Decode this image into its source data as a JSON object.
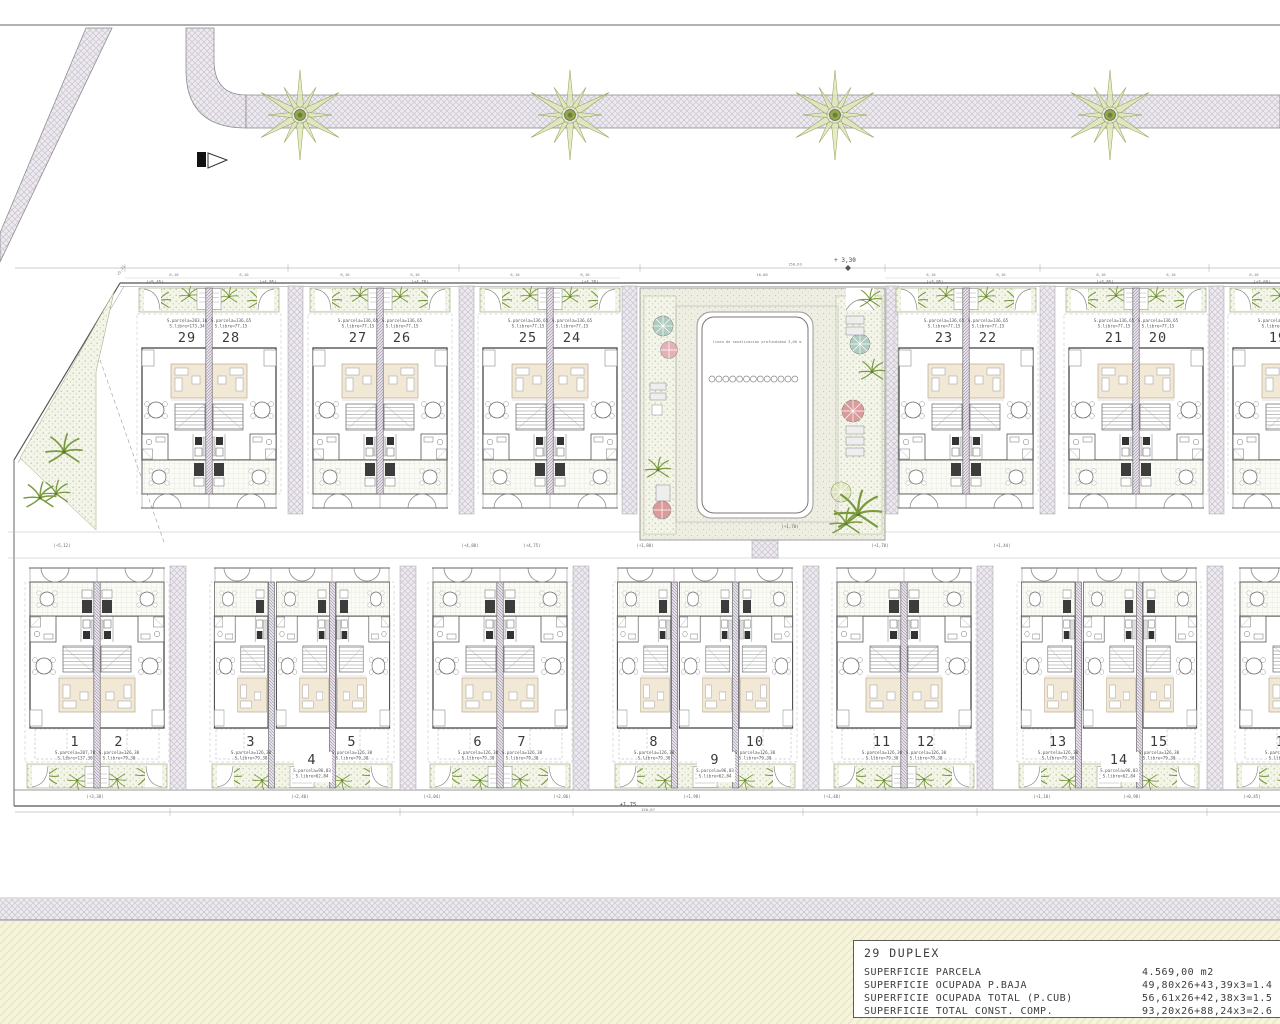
{
  "site": {
    "pool_label": "linea de senalizacion profundidad 3,00 m",
    "level_top_right": "+ 3,30",
    "level_left": "+5,21",
    "level_bottom": "+1,75",
    "dim_top": "150,63",
    "dim_bottom": "150,67",
    "street_tree_count": 4
  },
  "top_row": {
    "units": [
      {
        "n": "29",
        "a1": "S.parcela=203,16",
        "a2": "S.libre=173,34"
      },
      {
        "n": "28",
        "a1": "S.parcela=136,65",
        "a2": "S.libre=77,15"
      },
      {
        "n": "27",
        "a1": "S.parcela=136,65",
        "a2": "S.libre=77,15"
      },
      {
        "n": "26",
        "a1": "S.parcela=136,65",
        "a2": "S.libre=77,15"
      },
      {
        "n": "25",
        "a1": "S.parcela=136,65",
        "a2": "S.libre=77,15"
      },
      {
        "n": "24",
        "a1": "S.parcela=136,65",
        "a2": "S.libre=77,15"
      },
      {
        "n": "23",
        "a1": "S.parcela=136,65",
        "a2": "S.libre=77,15"
      },
      {
        "n": "22",
        "a1": "S.parcela=136,65",
        "a2": "S.libre=77,15"
      },
      {
        "n": "21",
        "a1": "S.parcela=136,65",
        "a2": "S.libre=77,15"
      },
      {
        "n": "20",
        "a1": "S.parcela=136,65",
        "a2": "S.libre=77,15"
      },
      {
        "n": "19",
        "a1": "S.parcela=136,65",
        "a2": "S.libre=77,15"
      },
      {
        "n": "18",
        "a1": "S.parcela=136,65",
        "a2": "S.libre=77,15"
      }
    ]
  },
  "bottom_row": {
    "units": [
      {
        "n": "1",
        "a1": "S.parcela=207,70",
        "a2": "S.libre=137,30"
      },
      {
        "n": "2",
        "a1": "S.parcela=126,30",
        "a2": "S.libre=79,30"
      },
      {
        "n": "3",
        "a1": "S.parcela=126,30",
        "a2": "S.libre=79,30"
      },
      {
        "n": "4",
        "a1": "S.parcela=96,03",
        "a2": "S.libre=62,84"
      },
      {
        "n": "5",
        "a1": "S.parcela=126,30",
        "a2": "S.libre=79,30"
      },
      {
        "n": "6",
        "a1": "S.parcela=126,30",
        "a2": "S.libre=79,30"
      },
      {
        "n": "7",
        "a1": "S.parcela=126,30",
        "a2": "S.libre=79,30"
      },
      {
        "n": "8",
        "a1": "S.parcela=126,30",
        "a2": "S.libre=79,30"
      },
      {
        "n": "9",
        "a1": "S.parcela=96,03",
        "a2": "S.libre=62,84"
      },
      {
        "n": "10",
        "a1": "S.parcela=126,30",
        "a2": "S.libre=79,30"
      },
      {
        "n": "11",
        "a1": "S.parcela=126,30",
        "a2": "S.libre=79,30"
      },
      {
        "n": "12",
        "a1": "S.parcela=126,30",
        "a2": "S.libre=79,30"
      },
      {
        "n": "13",
        "a1": "S.parcela=126,30",
        "a2": "S.libre=79,30"
      },
      {
        "n": "14",
        "a1": "S.parcela=96,03",
        "a2": "S.libre=62,84"
      },
      {
        "n": "15",
        "a1": "S.parcela=126,30",
        "a2": "S.libre=79,30"
      },
      {
        "n": "16",
        "a1": "S.parcela=126,30",
        "a2": "S.libre=79,30"
      },
      {
        "n": "17",
        "a1": "S.parcela=126,30",
        "a2": "S.libre=79,30"
      }
    ]
  },
  "annotations": [
    {
      "t": "(+5,45)",
      "x": 155,
      "y": 283.5
    },
    {
      "t": "(+4,85)",
      "x": 268,
      "y": 283.5
    },
    {
      "t": "(+4,78)",
      "x": 420,
      "y": 283.5
    },
    {
      "t": "(+4,70)",
      "x": 590,
      "y": 283.5
    },
    {
      "t": "(+3,95)",
      "x": 935,
      "y": 283.5
    },
    {
      "t": "(+3,85)",
      "x": 1105,
      "y": 283.5
    },
    {
      "t": "(+3,60)",
      "x": 1262,
      "y": 283.5
    },
    {
      "t": "6,10",
      "x": 174,
      "y": 276
    },
    {
      "t": "6,10",
      "x": 244,
      "y": 276
    },
    {
      "t": "6,10",
      "x": 345,
      "y": 276
    },
    {
      "t": "6,10",
      "x": 415,
      "y": 276
    },
    {
      "t": "6,10",
      "x": 515,
      "y": 276
    },
    {
      "t": "6,10",
      "x": 585,
      "y": 276
    },
    {
      "t": "16,60",
      "x": 762,
      "y": 276
    },
    {
      "t": "6,10",
      "x": 931,
      "y": 276
    },
    {
      "t": "6,10",
      "x": 1001,
      "y": 276
    },
    {
      "t": "6,10",
      "x": 1101,
      "y": 276
    },
    {
      "t": "6,10",
      "x": 1171,
      "y": 276
    },
    {
      "t": "6,10",
      "x": 1254,
      "y": 276
    },
    {
      "t": "(+5,12)",
      "x": 62,
      "y": 547
    },
    {
      "t": "(+4,88)",
      "x": 470,
      "y": 547
    },
    {
      "t": "(+4,75)",
      "x": 532,
      "y": 547
    },
    {
      "t": "(+1,80)",
      "x": 645,
      "y": 547
    },
    {
      "t": "(+1,70)",
      "x": 880,
      "y": 547
    },
    {
      "t": "(+1,44)",
      "x": 1002,
      "y": 547
    },
    {
      "t": "(+1,70)",
      "x": 790,
      "y": 528
    },
    {
      "t": "(+3,38)",
      "x": 95,
      "y": 798
    },
    {
      "t": "(+2,40)",
      "x": 300,
      "y": 798
    },
    {
      "t": "(+3,04)",
      "x": 432,
      "y": 798
    },
    {
      "t": "(+2,06)",
      "x": 562,
      "y": 798
    },
    {
      "t": "(+1,98)",
      "x": 692,
      "y": 798
    },
    {
      "t": "(+1,48)",
      "x": 832,
      "y": 798
    },
    {
      "t": "(+1,18)",
      "x": 1042,
      "y": 798
    },
    {
      "t": "(+0,98)",
      "x": 1132,
      "y": 798
    },
    {
      "t": "(+0,45)",
      "x": 1252,
      "y": 798
    }
  ],
  "title_block": {
    "title": "29 DUPLEX",
    "rows": [
      {
        "label": "SUPERFICIE PARCELA",
        "value": "4.569,00 m2"
      },
      {
        "label": "SUPERFICIE OCUPADA P.BAJA",
        "value": "49,80x26+43,39x3=1.4"
      },
      {
        "label": "SUPERFICIE OCUPADA TOTAL (P.CUB)",
        "value": "56,61x26+42,38x3=1.5"
      },
      {
        "label": "SUPERFICIE TOTAL CONST. COMP.",
        "value": "93,20x26+88,24x3=2.6"
      }
    ]
  },
  "colors": {
    "line_dark": "#474747",
    "garden_green": "#7a9a3e",
    "beige_room": "#f1e8d6",
    "parasol_teal": "#a9c7bb",
    "parasol_pink": "#e3aab4",
    "parasol_red": "#d89191",
    "band_yellow": "#f7f4dc",
    "band_gray": "#ebe9f1"
  }
}
